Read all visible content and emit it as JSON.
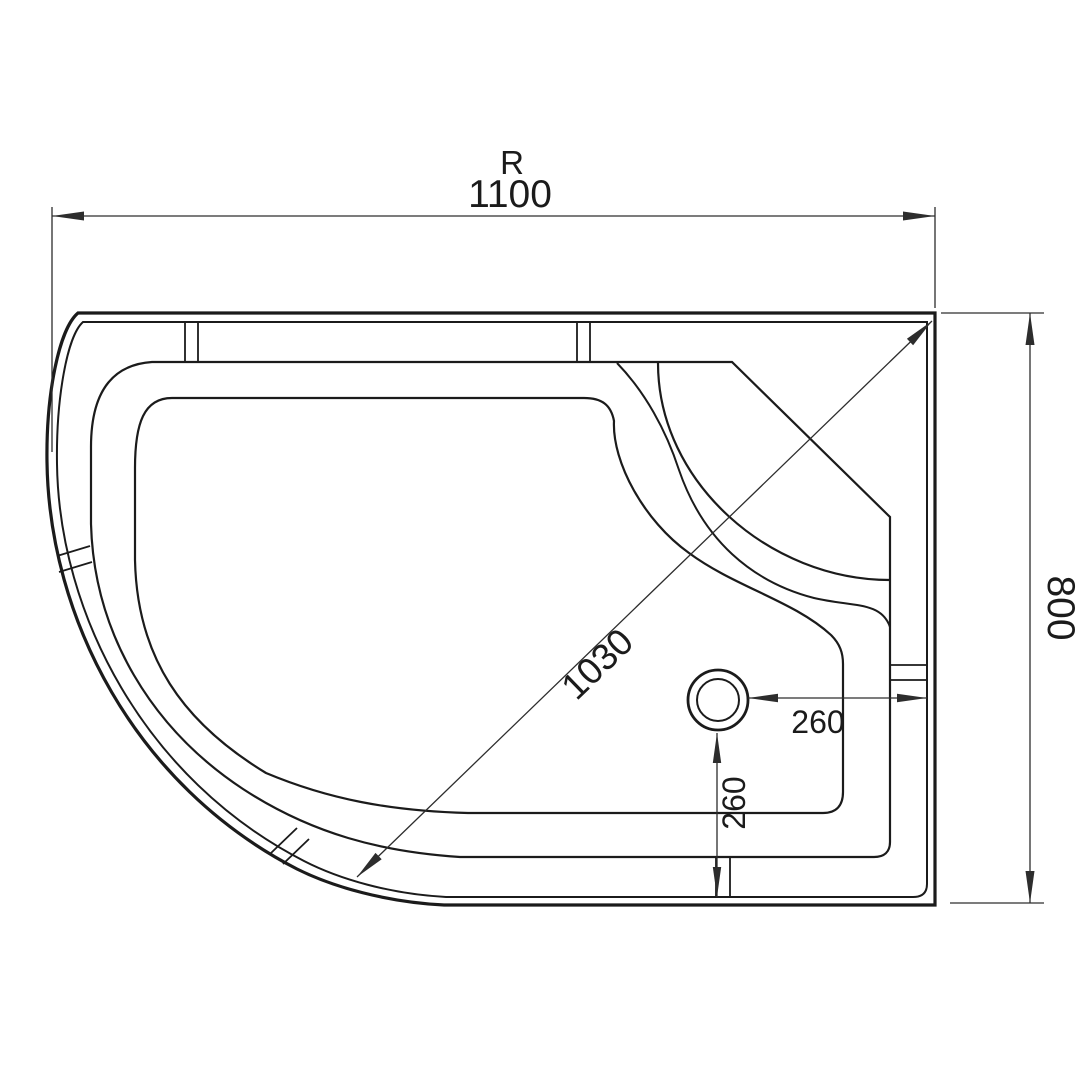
{
  "drawing": {
    "title": "shower tray plan view technical drawing",
    "background": "#ffffff",
    "line_color": "#1b1b1b",
    "dim_color": "#2d2d2d",
    "dimensions": {
      "radius_label": "R",
      "overall_width": "1100",
      "overall_depth": "800",
      "diagonal": "1030",
      "drain_offset_horizontal": "260",
      "drain_offset_vertical": "260"
    }
  }
}
